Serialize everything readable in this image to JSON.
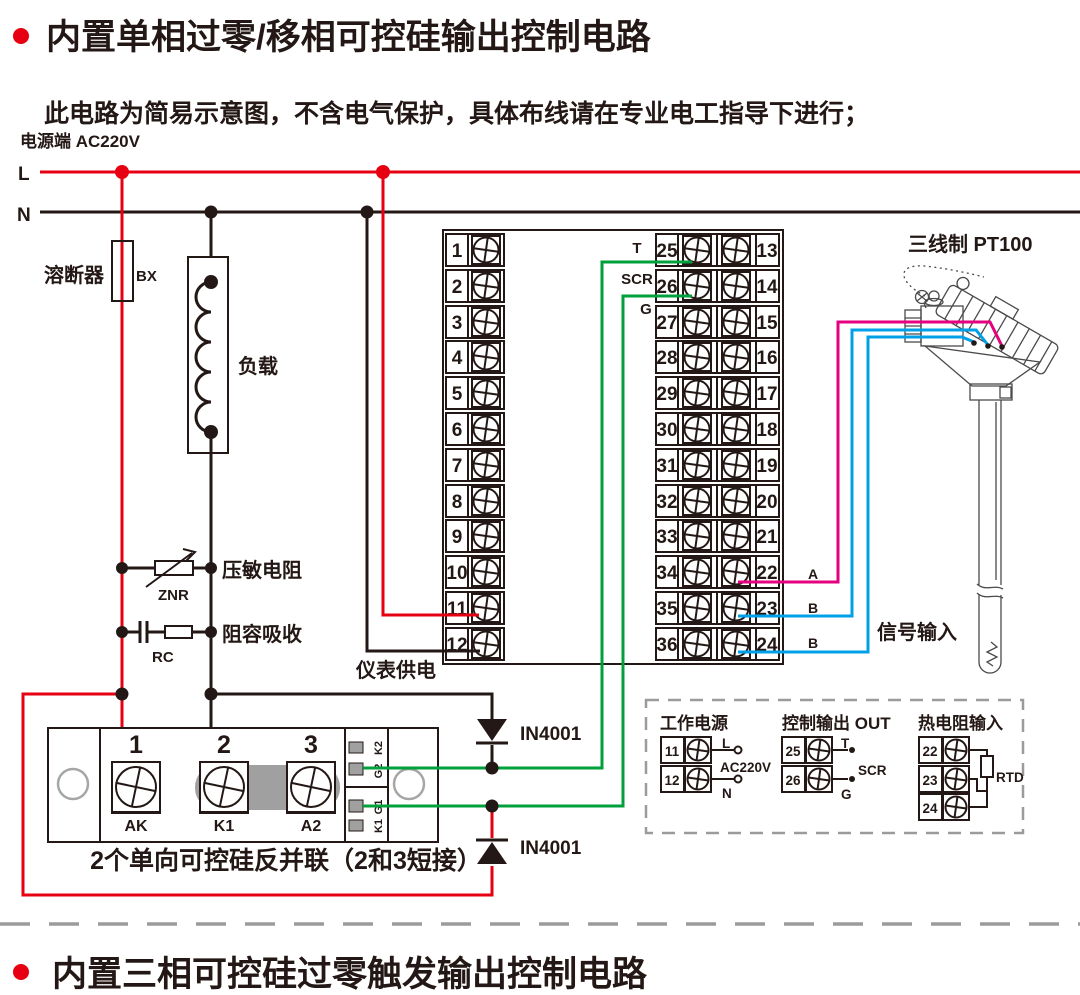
{
  "page": {
    "title": "内置单相过零/移相可控硅输出控制电路",
    "subtitle": "此电路为简易示意图，不含电气保护，具体布线请在专业电工指导下进行；",
    "footer_title": "内置三相可控硅过零触发输出控制电路"
  },
  "colors": {
    "wire_red": "#e60012",
    "wire_green": "#00a03c",
    "wire_magenta": "#e4007f",
    "wire_cyan": "#00a0e9",
    "wire_black": "#231815",
    "muted_gray": "#9b9b9b",
    "shade_gray": "#a0a0a0"
  },
  "power": {
    "source_label": "电源端  AC220V",
    "line_l": "L",
    "line_n": "N",
    "fuse_label": "溶断器",
    "fuse_code": "BX",
    "load_label": "负载",
    "varistor_label": "压敏电阻",
    "varistor_code": "ZNR",
    "snubber_label": "阻容吸收",
    "snubber_code": "RC"
  },
  "block": {
    "left": [
      "1",
      "2",
      "3",
      "4",
      "5",
      "6",
      "7",
      "8",
      "9",
      "10",
      "11",
      "12"
    ],
    "mid": [
      "25",
      "26",
      "27",
      "28",
      "29",
      "30",
      "31",
      "32",
      "33",
      "34",
      "35",
      "36"
    ],
    "right": [
      "13",
      "14",
      "15",
      "16",
      "17",
      "18",
      "19",
      "20",
      "21",
      "22",
      "23",
      "24"
    ],
    "label_t": "T",
    "label_scr": "SCR",
    "label_g": "G",
    "supply_label": "仪表供电"
  },
  "sensor": {
    "title": "三线制 PT100",
    "wire_a": "A",
    "wire_b1": "B",
    "wire_b2": "B",
    "signal_label": "信号输入"
  },
  "module": {
    "t1": "1",
    "t2": "2",
    "t3": "3",
    "ak": "AK",
    "k1": "K1",
    "a2": "A2",
    "pins": [
      "K2",
      "G2",
      "G1",
      "K1"
    ],
    "caption": "2个单向可控硅反并联（2和3短接）"
  },
  "diodes": {
    "d1": "IN4001",
    "d2": "IN4001"
  },
  "inset": {
    "power": {
      "title": "工作电源",
      "t1": "11",
      "t2": "12",
      "l": "L",
      "n": "N",
      "voltage": "AC220V"
    },
    "out": {
      "title": "控制输出 OUT",
      "t1": "25",
      "t2": "26",
      "t": "T",
      "scr": "SCR",
      "g": "G"
    },
    "rtd": {
      "title": "热电阻输入",
      "t1": "22",
      "t2": "23",
      "t3": "24",
      "label": "RTD"
    }
  }
}
